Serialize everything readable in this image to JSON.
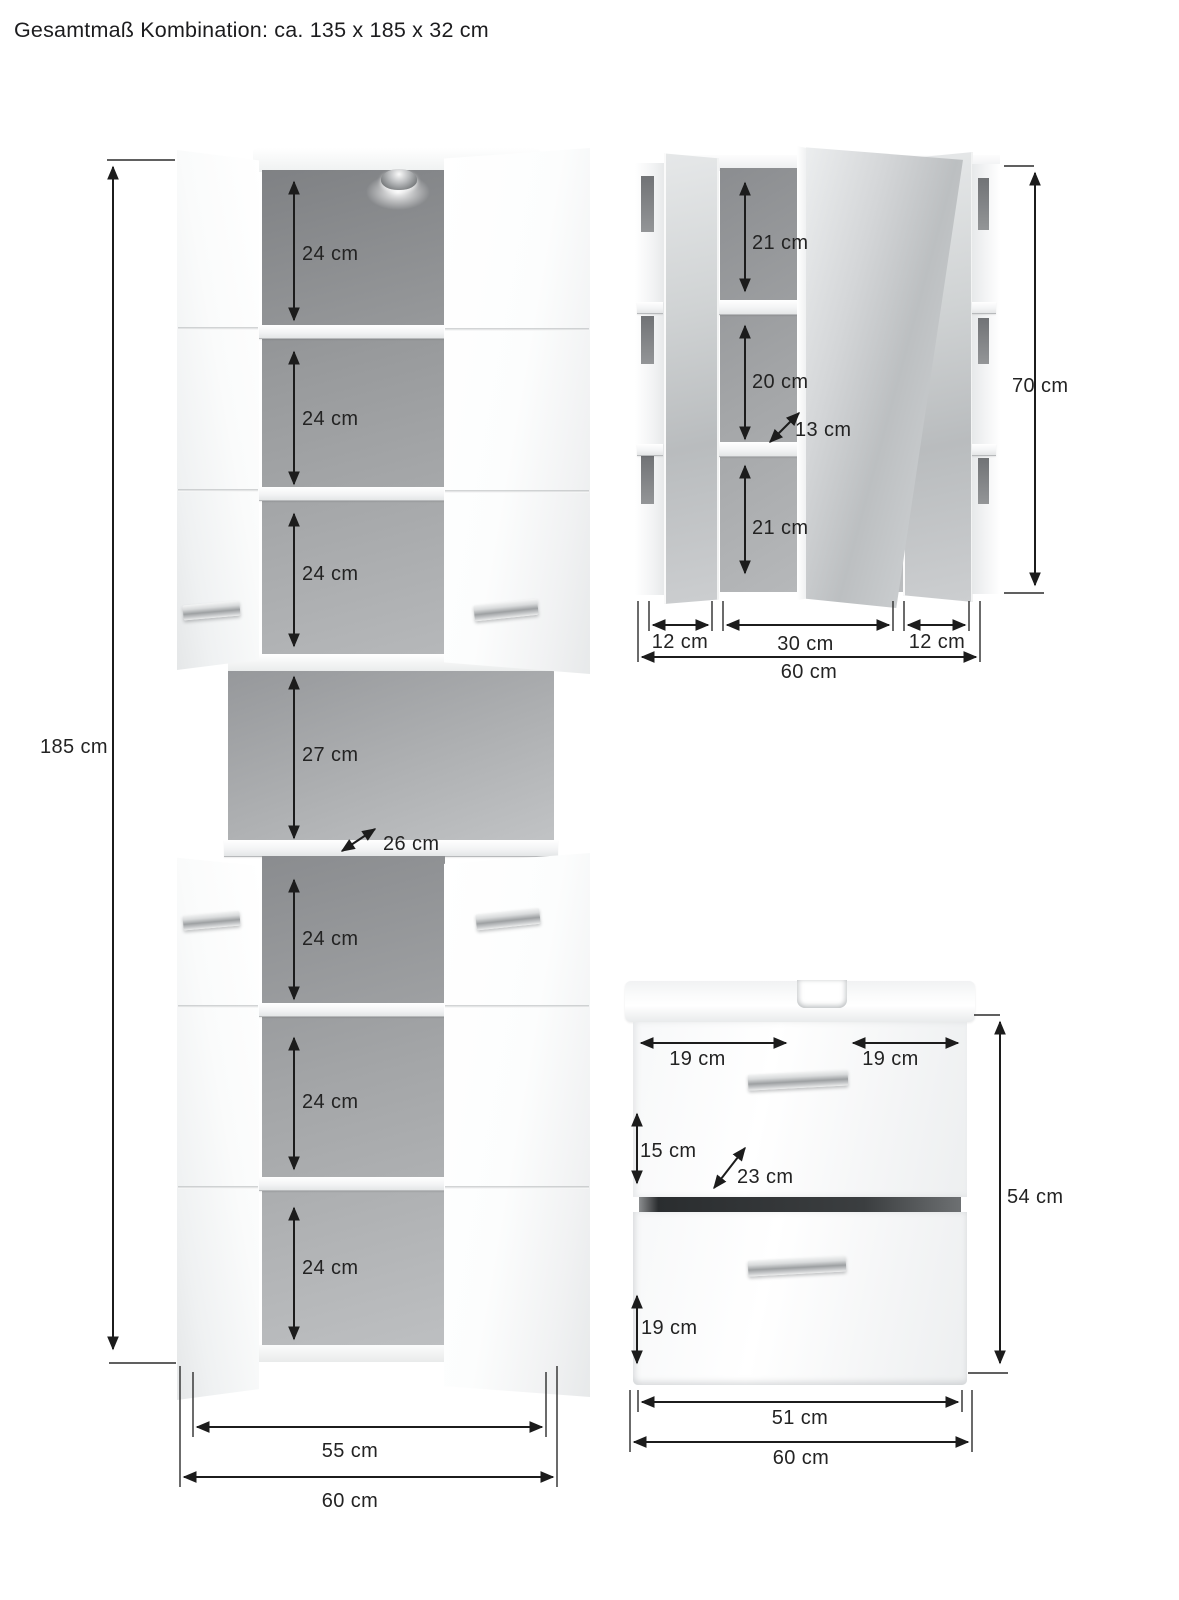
{
  "title": "Gesamtmaß Kombination: ca. 135 x 185 x 32 cm",
  "tall_cabinet": {
    "height": "185 cm",
    "compartments_top": [
      "24 cm",
      "24 cm",
      "24 cm"
    ],
    "open_compartment": "27 cm",
    "open_depth": "26 cm",
    "compartments_bottom": [
      "24 cm",
      "24 cm",
      "24 cm"
    ],
    "inner_width": "55 cm",
    "outer_width": "60 cm"
  },
  "mirror_cabinet": {
    "height": "70 cm",
    "compartments": [
      "21 cm",
      "20 cm",
      "21 cm"
    ],
    "shelf_depth": "13 cm",
    "door_widths": [
      "12 cm",
      "30 cm",
      "12 cm"
    ],
    "outer_width": "60 cm"
  },
  "washbasin_cabinet": {
    "height": "54 cm",
    "top_widths": [
      "19 cm",
      "19 cm"
    ],
    "drawer_top_height": "15 cm",
    "drawer_depth": "23 cm",
    "drawer_bottom_height": "19 cm",
    "inner_width": "51 cm",
    "outer_width": "60 cm"
  }
}
